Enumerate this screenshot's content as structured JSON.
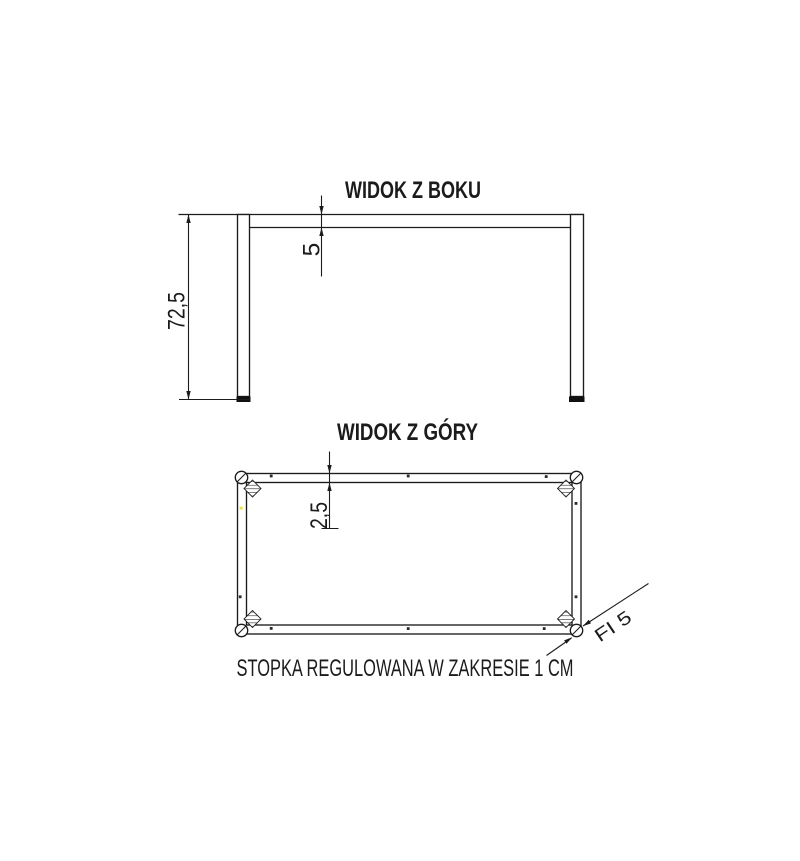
{
  "drawing": {
    "background_color": "#ffffff",
    "line_color": "#1c1c1c",
    "text_color": "#1b1b1b",
    "foot_glide_color": "#111111",
    "yellow_dot_color": "#e9e34e",
    "side_view": {
      "title": "WIDOK Z BOKU",
      "height_dim": "72,5",
      "top_thickness_dim": "5"
    },
    "top_view": {
      "title": "WIDOK Z GÓRY",
      "frame_thickness_dim": "2,5",
      "foot_diameter_label": "FI 5"
    },
    "caption": "STOPKA REGULOWANA W ZAKRESIE 1 CM"
  }
}
